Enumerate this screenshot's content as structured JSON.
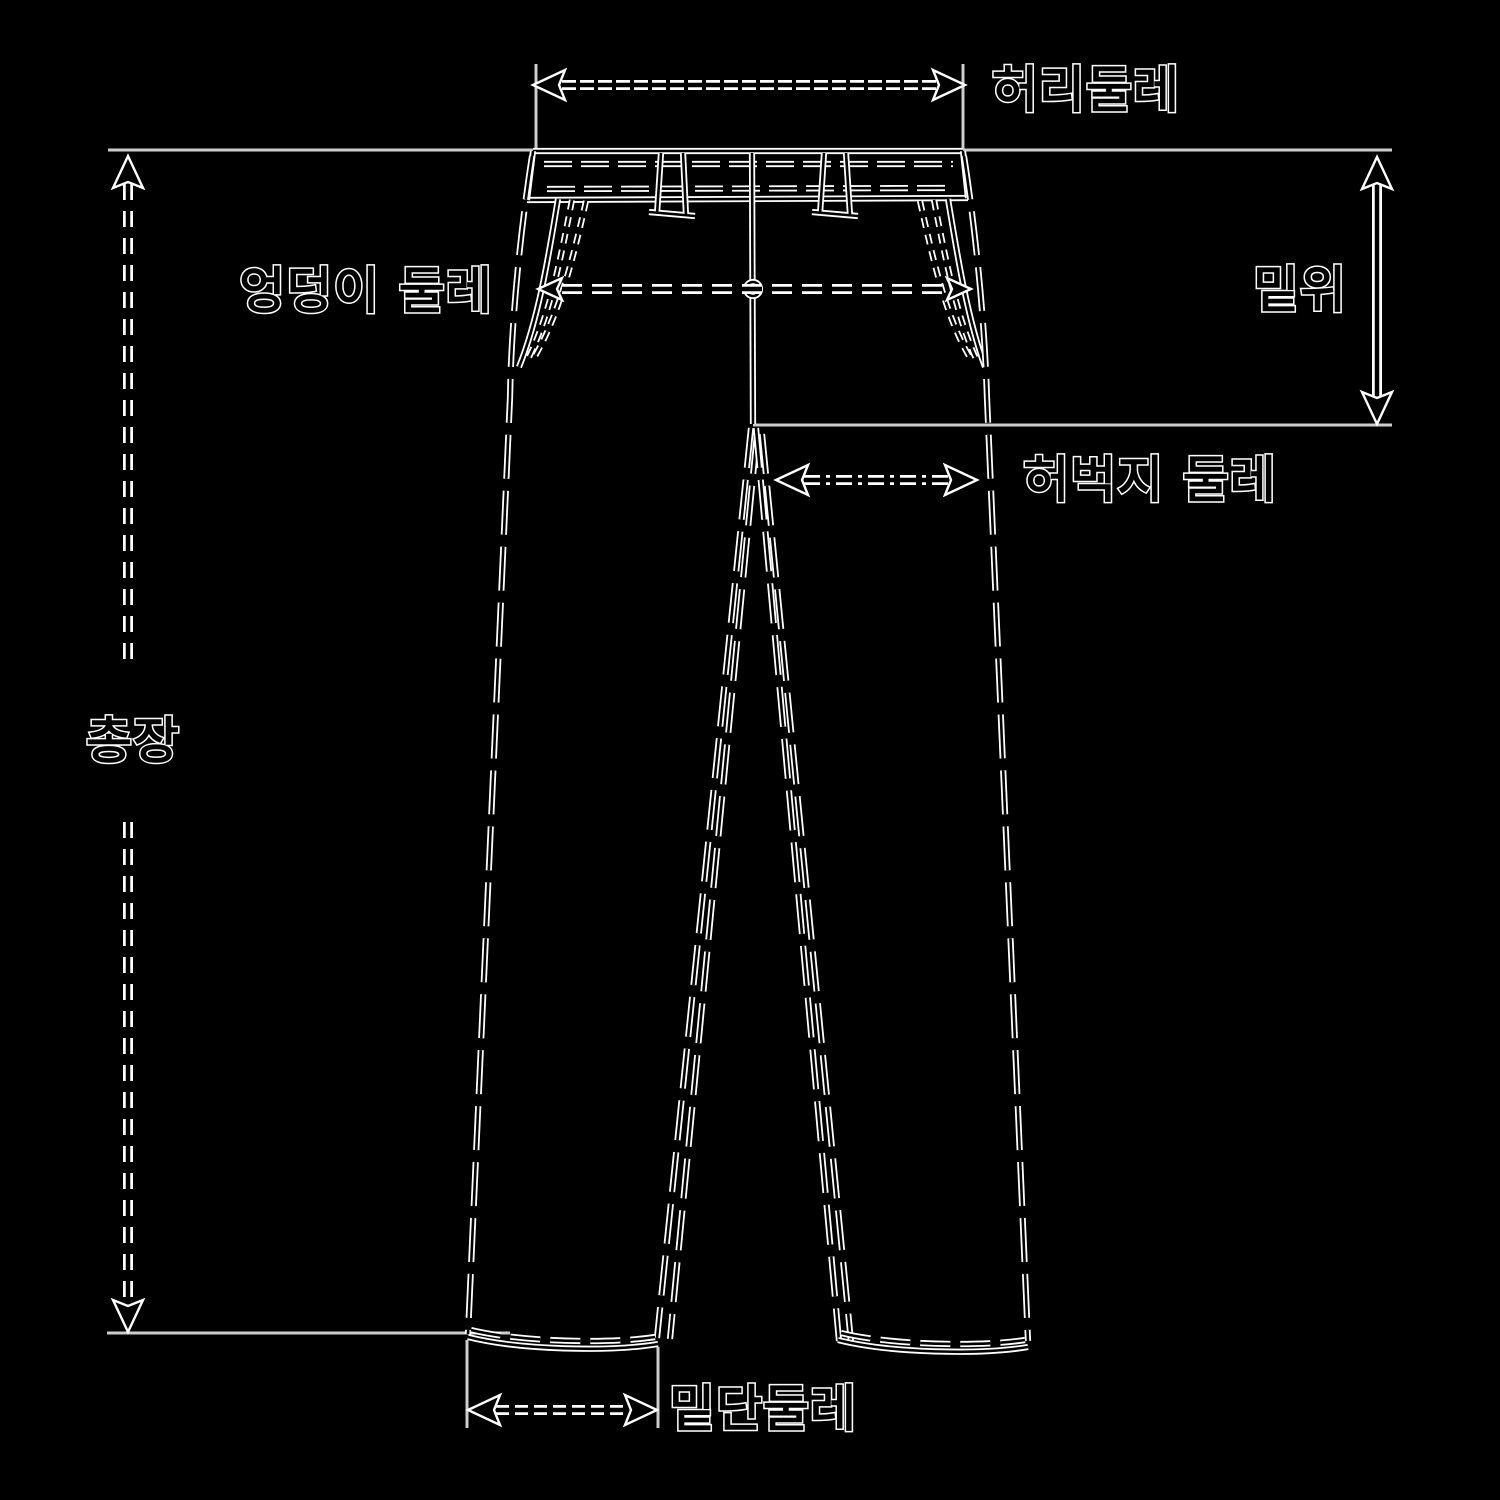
{
  "labels": {
    "waist": "허리둘레",
    "hip": "엉덩이 둘레",
    "rise": "밑위",
    "thigh": "허벅지 둘레",
    "total_length": "총장",
    "hem": "밑단둘레"
  },
  "colors": {
    "background": "#000000",
    "line_core": "#000000",
    "line_halo": "#ffffff",
    "reference_line": "#cccccc",
    "text_fill": "#000000",
    "text_outline": "#ffffff"
  }
}
